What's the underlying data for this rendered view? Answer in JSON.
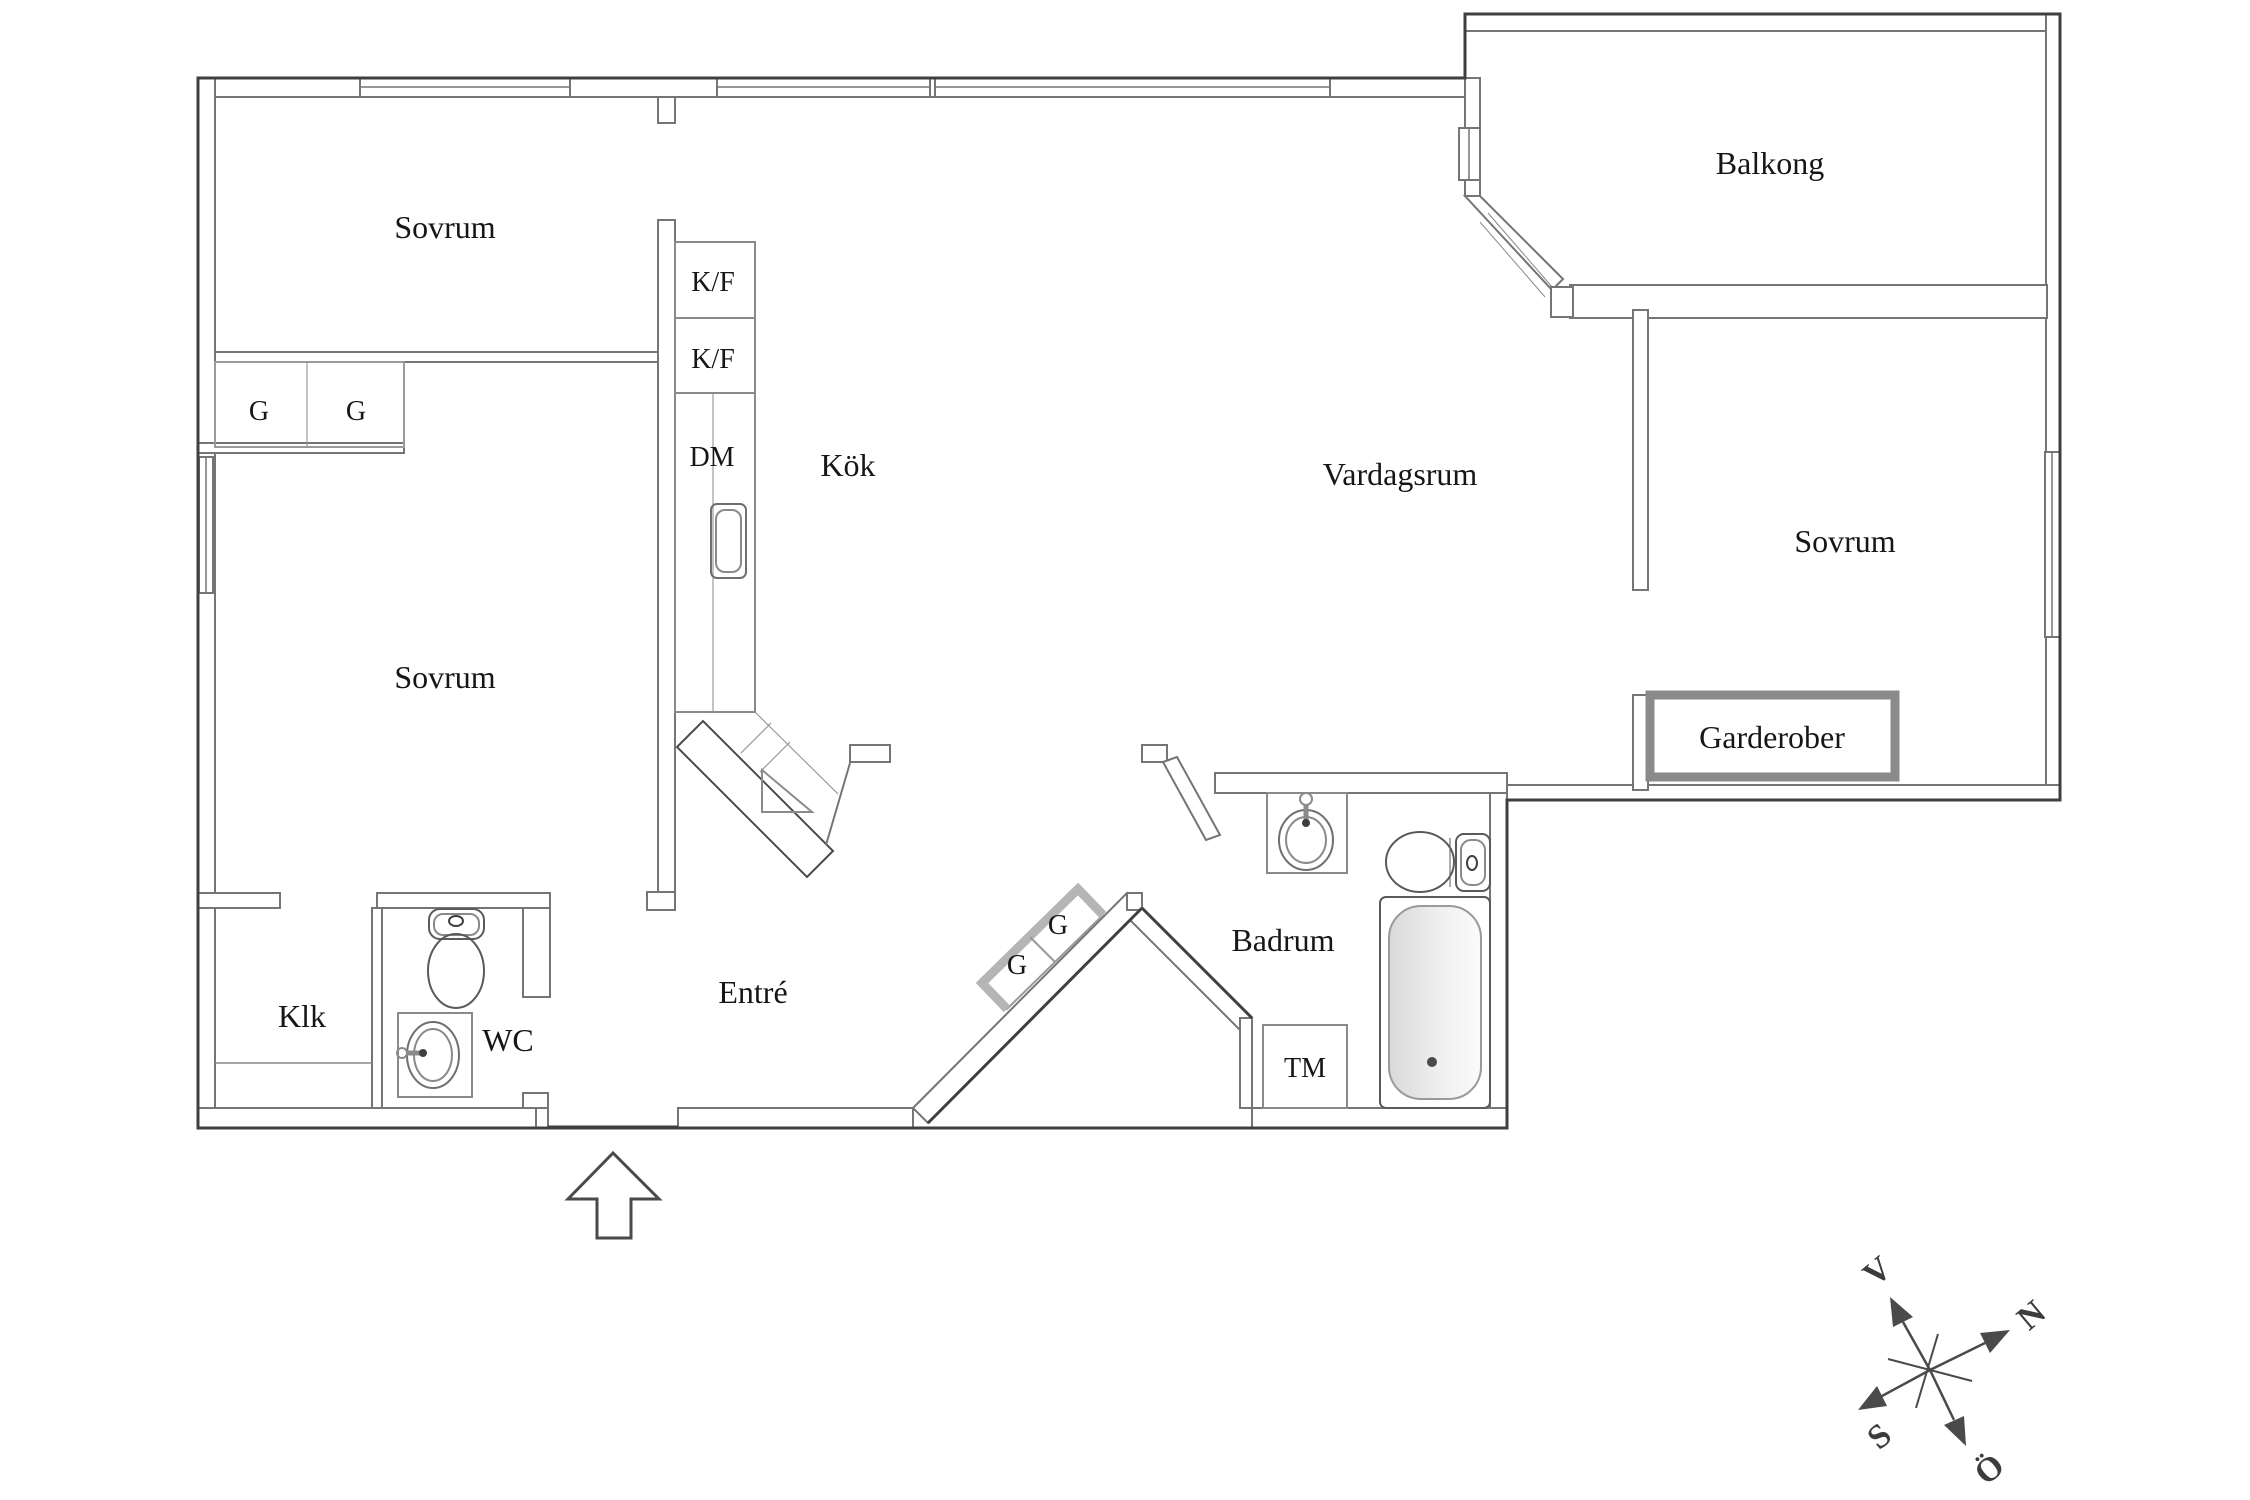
{
  "labels": {
    "sovrum_top": "Sovrum",
    "sovrum_lower": "Sovrum",
    "sovrum_right": "Sovrum",
    "kok": "Kök",
    "vardagsrum": "Vardagsrum",
    "balkong": "Balkong",
    "entre": "Entré",
    "klk": "Klk",
    "wc": "WC",
    "badrum": "Badrum",
    "garderober": "Garderober",
    "tm": "TM",
    "dm": "DM",
    "kf_upper": "K/F",
    "kf_lower": "K/F",
    "g_closet_left": "G",
    "g_closet_right": "G",
    "g_hall_lower": "G",
    "g_hall_upper": "G",
    "compass_v": "V",
    "compass_n": "N",
    "compass_s": "S",
    "compass_o": "Ö"
  },
  "colors": {
    "outer_wall": "#3f3f3f",
    "inner_wall": "#757575",
    "fixture_line": "#8a8a8a",
    "closet_border": "#b5b5b5",
    "garderober_border": "#8a8a8a",
    "compass": "#4a4a4a",
    "tub_shade": "#d9d9d9"
  }
}
